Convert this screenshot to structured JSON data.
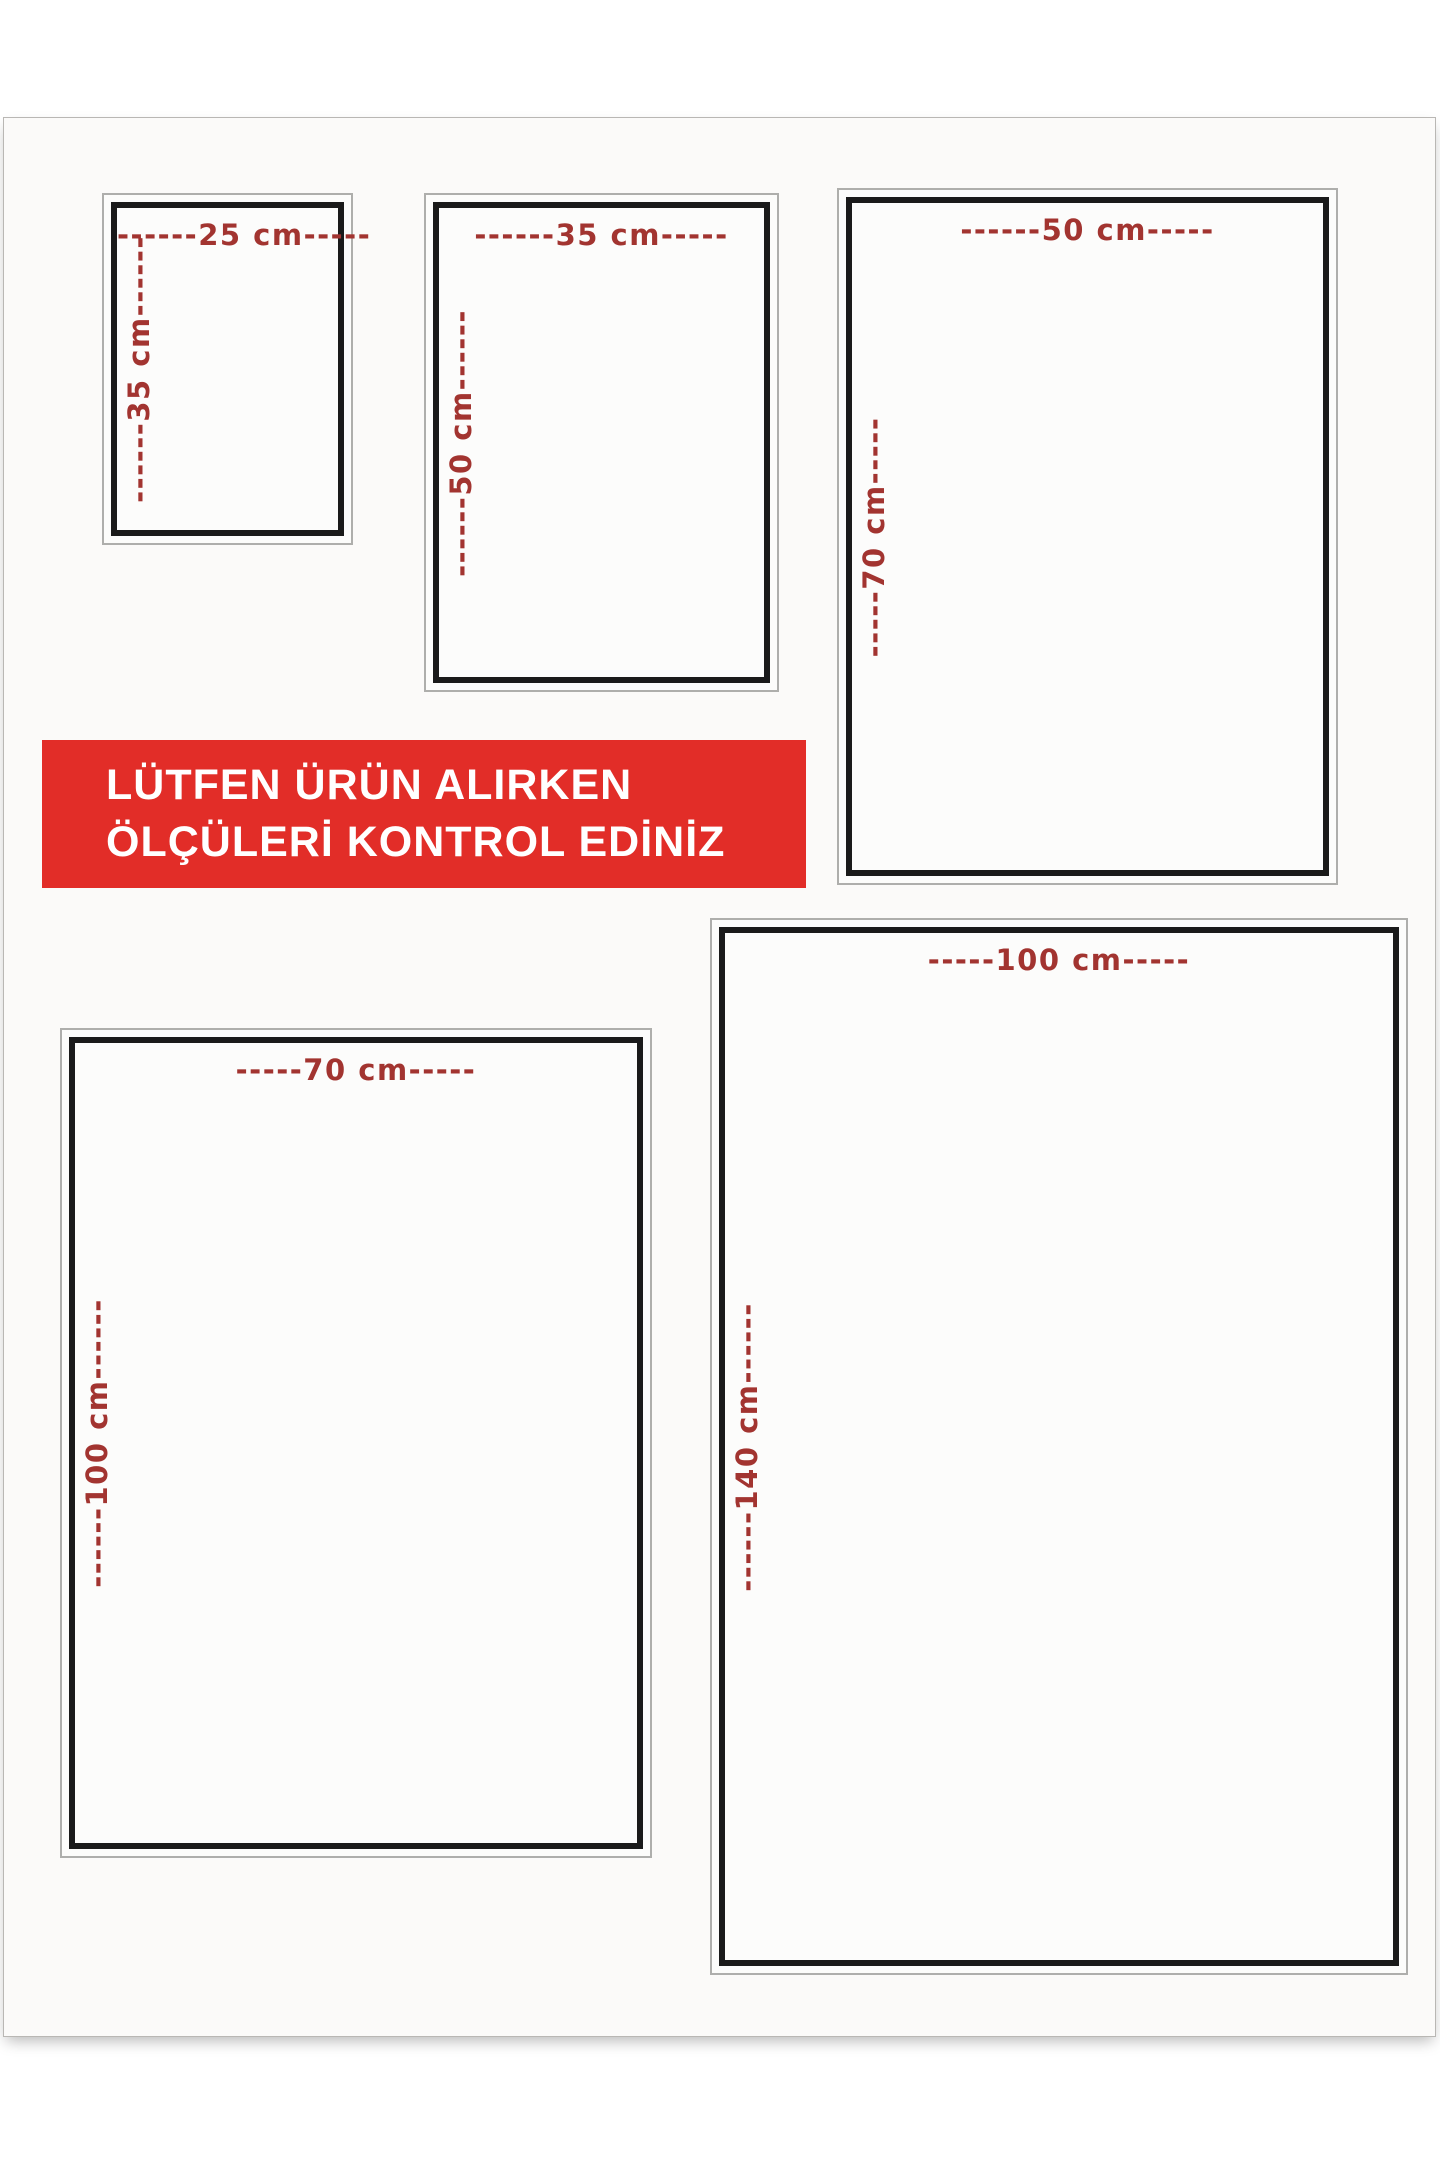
{
  "page": {
    "background_color": "#fbfaf9"
  },
  "banner": {
    "line1": "LÜTFEN ÜRÜN ALIRKEN",
    "line2": "ÖLÇÜLERİ KONTROL EDİNİZ",
    "background_color": "#e22d28",
    "text_color": "#ffffff"
  },
  "colors": {
    "dimension_label_red": "#a23430",
    "frame_inner_border_black": "#1a1a1a",
    "frame_outer_border_gray": "#aeaeac"
  },
  "size_boxes": [
    {
      "width_cm": 25,
      "height_cm": 35,
      "top_label": "------25 cm-----",
      "side_label": "------35 cm------"
    },
    {
      "width_cm": 35,
      "height_cm": 50,
      "top_label": "------35 cm-----",
      "side_label": "------50 cm------"
    },
    {
      "width_cm": 50,
      "height_cm": 70,
      "top_label": "------50 cm-----",
      "side_label": "-----70 cm-----"
    },
    {
      "width_cm": 70,
      "height_cm": 100,
      "top_label": "-----70 cm-----",
      "side_label": "------100 cm------"
    },
    {
      "width_cm": 100,
      "height_cm": 140,
      "top_label": "-----100 cm-----",
      "side_label": "------140 cm------"
    }
  ]
}
